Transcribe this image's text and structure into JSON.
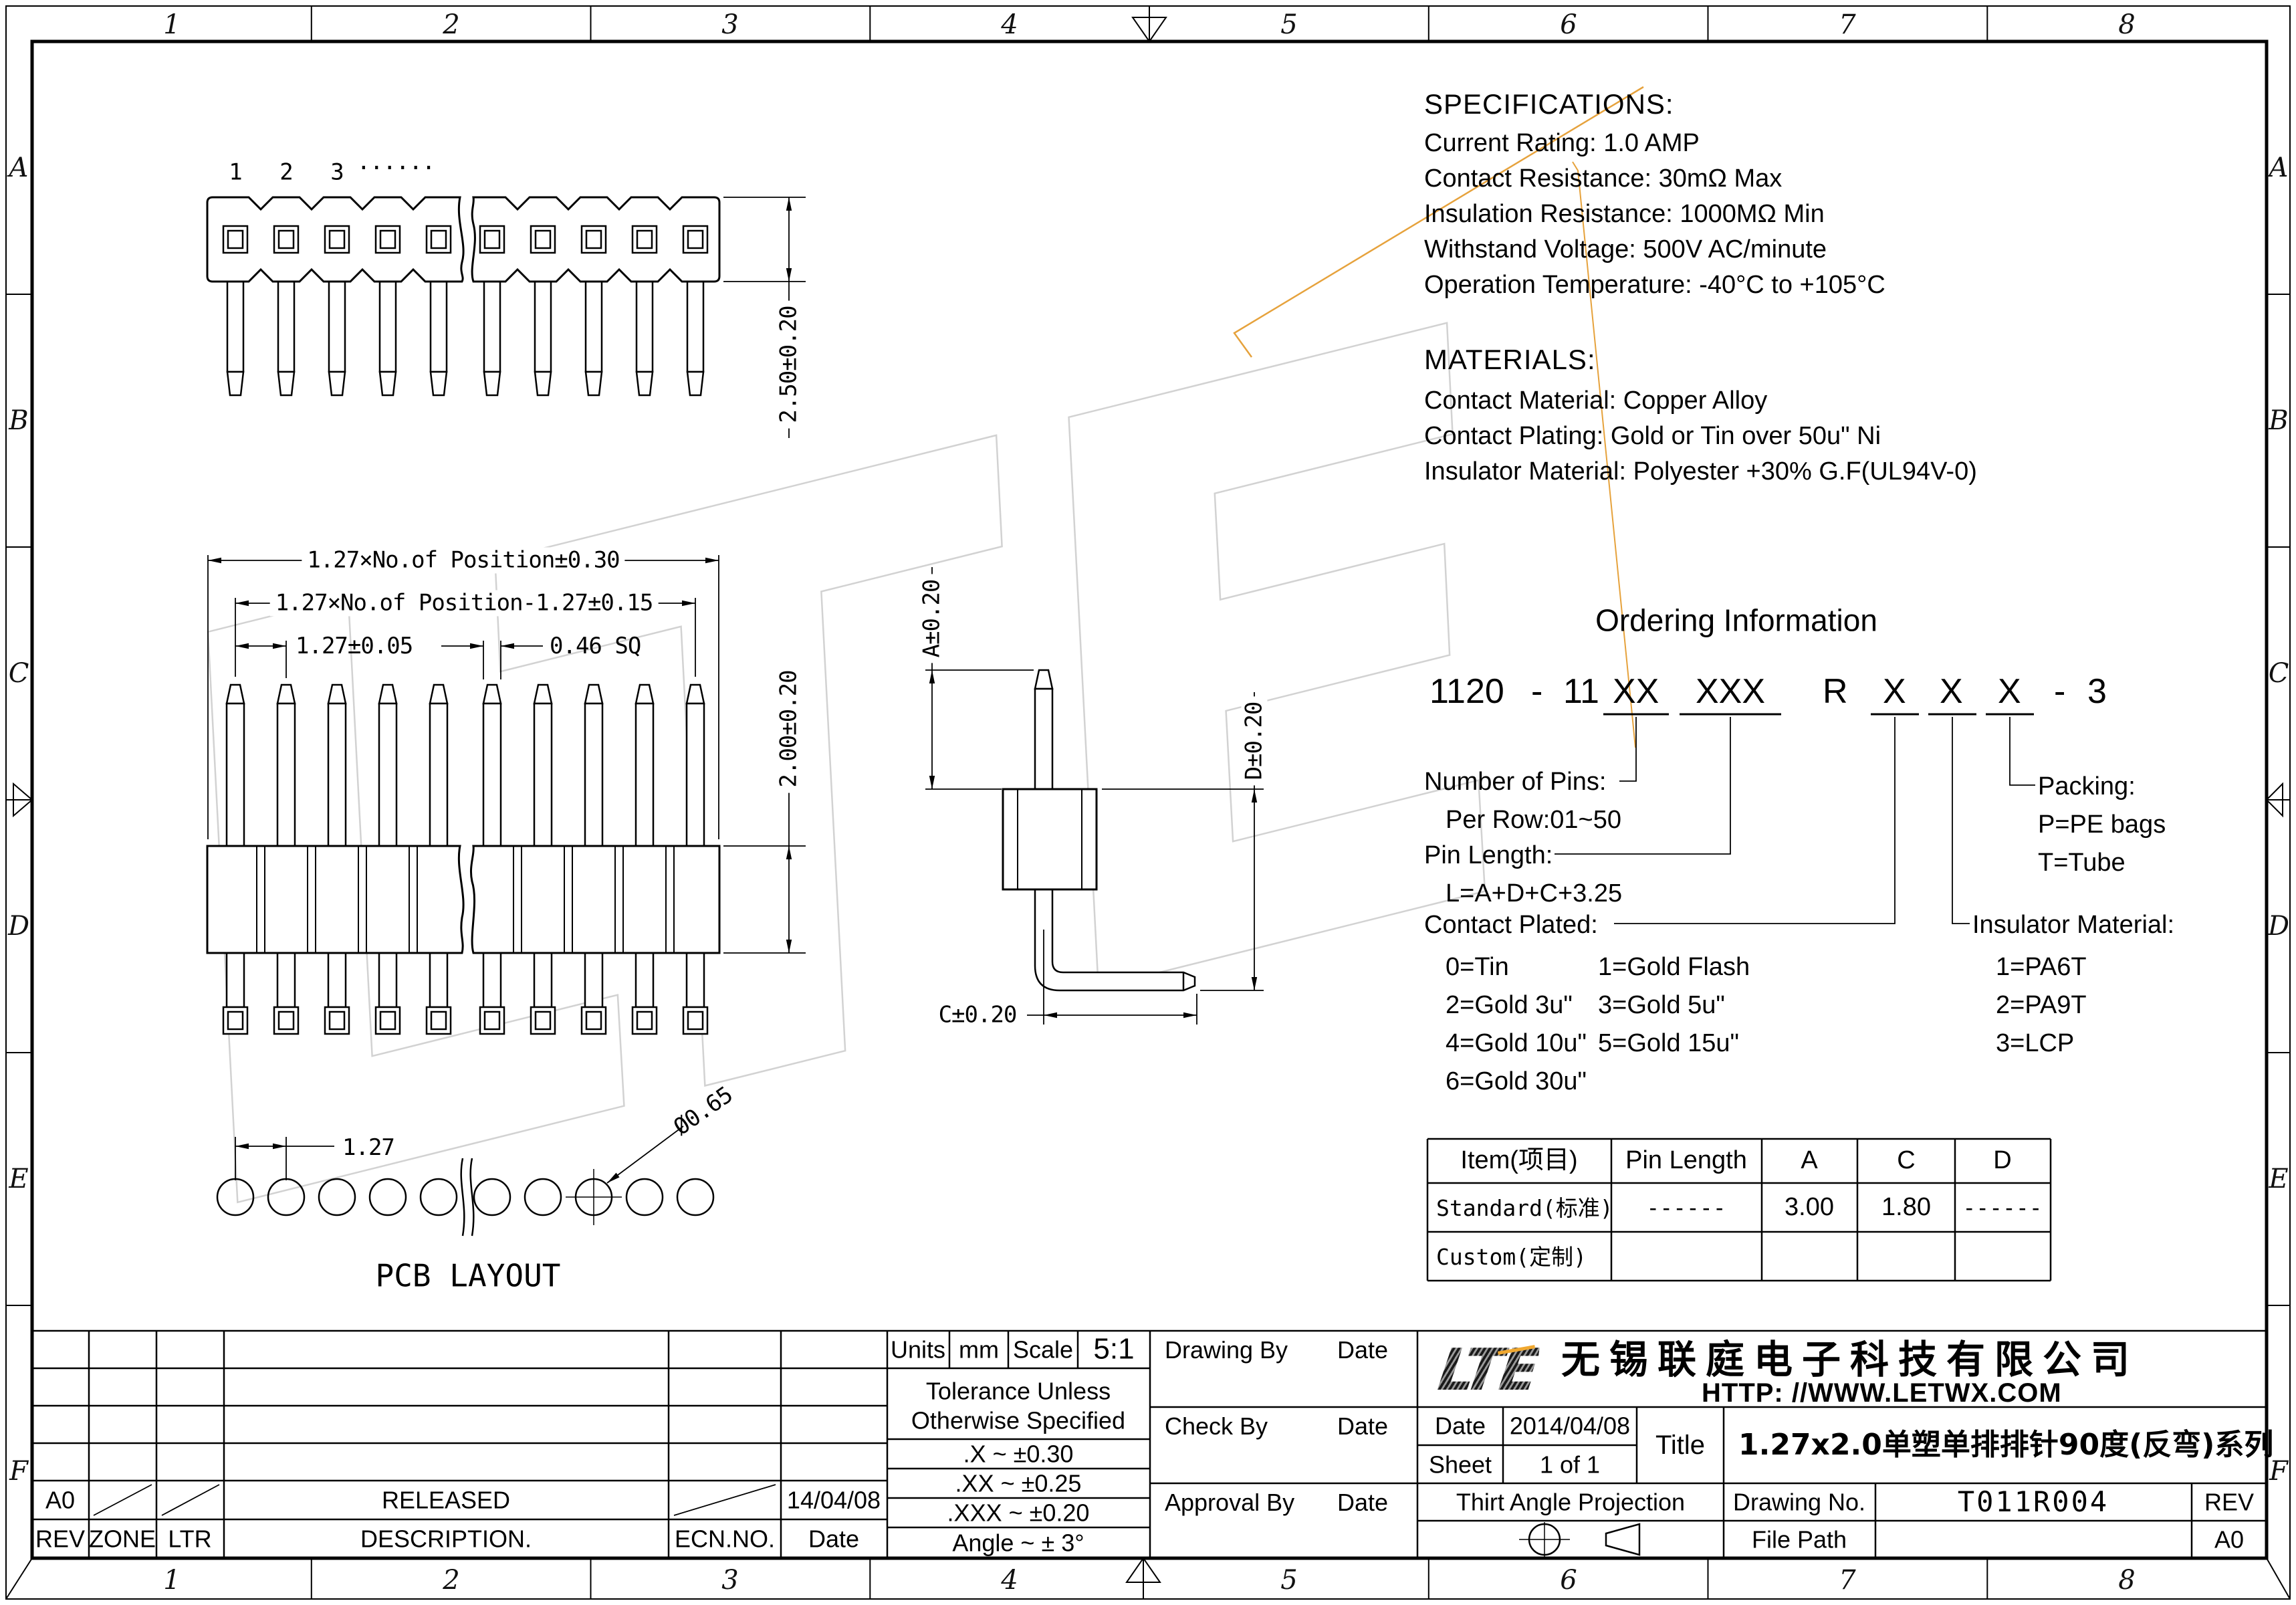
{
  "watermark": {
    "text": "LTE"
  },
  "border": {
    "cols": [
      "1",
      "2",
      "3",
      "4",
      "5",
      "6",
      "7",
      "8"
    ],
    "rows": [
      "A",
      "B",
      "C",
      "D",
      "E",
      "F"
    ]
  },
  "specs": {
    "title": "SPECIFICATIONS:",
    "lines": [
      "Current Rating: 1.0 AMP",
      "Contact Resistance: 30mΩ Max",
      "Insulation Resistance: 1000MΩ Min",
      "Withstand Voltage: 500V AC/minute",
      "Operation Temperature: -40°C to +105°C"
    ]
  },
  "materials": {
    "title": "MATERIALS:",
    "lines": [
      "Contact Material: Copper Alloy",
      "Contact Plating: Gold or Tin over 50u\" Ni",
      "Insulator Material: Polyester +30% G.F(UL94V-0)"
    ]
  },
  "ordering": {
    "title": "Ordering Information",
    "code_parts": [
      "1120",
      "-",
      "11",
      "XX",
      "XXX",
      "R",
      "X",
      "X",
      "X",
      "-",
      "3"
    ],
    "number_of_pins_label": "Number of Pins:",
    "number_of_pins_value": "Per Row:01~50",
    "pin_length_label": "Pin Length:",
    "pin_length_value": "L=A+D+C+3.25",
    "contact_plated_label": "Contact  Plated:",
    "contact_plated_options": [
      "0=Tin",
      "1=Gold Flash",
      "2=Gold  3u\"",
      "3=Gold  5u\"",
      "4=Gold 10u\"",
      "5=Gold 15u\"",
      "6=Gold  30u\""
    ],
    "packing_label": "Packing:",
    "packing_options": [
      "P=PE bags",
      "T=Tube"
    ],
    "insulator_label": "Insulator Material:",
    "insulator_options": [
      "1=PA6T",
      "2=PA9T",
      "3=LCP"
    ]
  },
  "spec_table": {
    "headers": [
      "Item(项目)",
      "Pin Length",
      "A",
      "C",
      "D"
    ],
    "rows": [
      [
        "Standard(标准)",
        "------",
        "3.00",
        "1.80",
        "------"
      ],
      [
        "Custom(定制)",
        "",
        "",
        "",
        ""
      ]
    ]
  },
  "views": {
    "pin_numbers": [
      "1",
      "2",
      "3",
      "······"
    ],
    "dim_2_50": "2.50±0.20",
    "dim_row1": "1.27×No.of Position±0.30",
    "dim_row2": "1.27×No.of Position-1.27±0.15",
    "dim_pitch": "1.27±0.05",
    "dim_sq": "0.46 SQ",
    "dim_2_00": "2.00±0.20",
    "dim_a": "A±0.20",
    "dim_d": "D±0.20",
    "dim_c": "C±0.20",
    "pcb": {
      "dim_pitch": "1.27",
      "dim_hole": "Ø0.65",
      "label": "PCB LAYOUT"
    }
  },
  "title_block": {
    "revision": {
      "headers": [
        "REV",
        "ZONE",
        "LTR",
        "DESCRIPTION.",
        "ECN.NO.",
        "Date"
      ],
      "row": {
        "rev": "A0",
        "description": "RELEASED",
        "date": "14/04/08"
      }
    },
    "tolerance": {
      "units_label": "Units",
      "units_value": "mm",
      "scale_label": "Scale",
      "scale_value": "5:1",
      "note_line1": "Tolerance Unless",
      "note_line2": "Otherwise Specified",
      "rows": [
        ".X  ~  ±0.30",
        ".XX  ~  ±0.25",
        ".XXX  ~  ±0.20",
        "Angle  ~  ± 3°"
      ]
    },
    "signatures": [
      {
        "label": "Drawing By",
        "date_label": "Date"
      },
      {
        "label": "Check  By",
        "date_label": "Date"
      },
      {
        "label": "Approval By",
        "date_label": "Date"
      }
    ],
    "company": {
      "logo": "LTE",
      "name": "无锡联庭电子科技有限公司",
      "url": "HTTP: //WWW.LETWX.COM",
      "date_label": "Date",
      "date_value": "2014/04/08",
      "sheet_label": "Sheet",
      "sheet_value": "1 of 1",
      "title_label": "Title",
      "title_value": "1.27x2.0单塑单排排针90度(反弯)系列",
      "projection_label": "Thirt Angle Projection",
      "drawing_no_label": "Drawing No.",
      "drawing_no_value": "T011R004",
      "rev_label": "REV",
      "rev_value": "A0",
      "file_path_label": "File Path"
    }
  }
}
